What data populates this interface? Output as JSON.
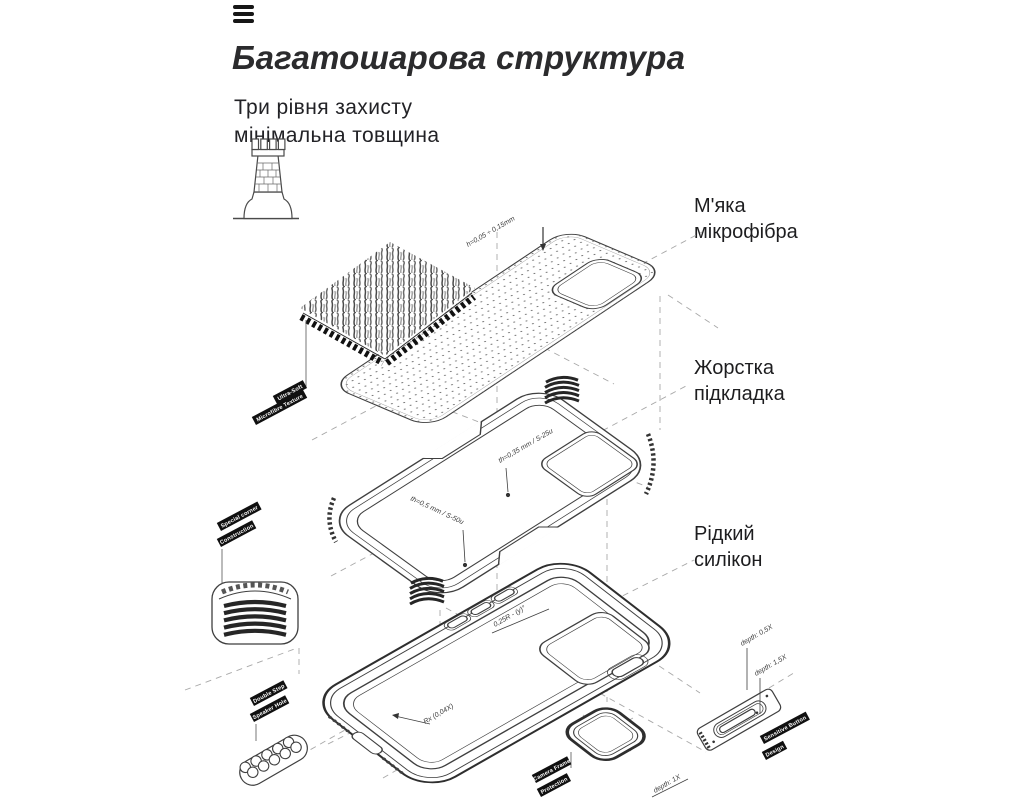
{
  "header": {
    "title": "Багатошарова структура",
    "subtitle_line1": "Три рівня захисту",
    "subtitle_line2": "мінімальна товщина"
  },
  "layer_labels": {
    "microfiber": {
      "line1": "М'яка",
      "line2": "мікрофібра"
    },
    "hard_lining": {
      "line1": "Жорстка",
      "line2": "підкладка"
    },
    "liquid_silicone": {
      "line1": "Рідкий",
      "line2": "силікон"
    }
  },
  "annotations": {
    "thickness_top": "h=0,05 ÷ 0,15mm",
    "thickness_035": "th=0,35 mm / S-25u",
    "thickness_05": "th=0,5 mm / S-50u",
    "radius_025": "0,25R - (y)°",
    "radius_bottom": "Rx (0,04X)",
    "depth_05": "depth: 0,5X",
    "depth_15": "depth: 1,5X",
    "depth_1": "depth: 1X"
  },
  "tags": {
    "ultra_soft": "Ultra-Soft",
    "microfibre_texture": "Microfibre Texture",
    "special_corner": "Special corner",
    "construction": "Construction",
    "double_step": "Double Step",
    "speaker_hole": "Speaker Hole",
    "camera_frame": "Camera Frame",
    "protection": "Protection",
    "sensitive_button": "Sensitive Button",
    "design": "Design"
  },
  "icons": {
    "fortress": "fortress-icon",
    "menu": "hamburger-icon"
  },
  "colors": {
    "background": "#ffffff",
    "line": "#3f3f3f",
    "dark_line": "#222222",
    "dashed": "#a3a3a3",
    "tag_bg": "#101010",
    "tag_text": "#ffffff",
    "heading": "#2b2b2d",
    "body_text": "#1d1d1f"
  }
}
